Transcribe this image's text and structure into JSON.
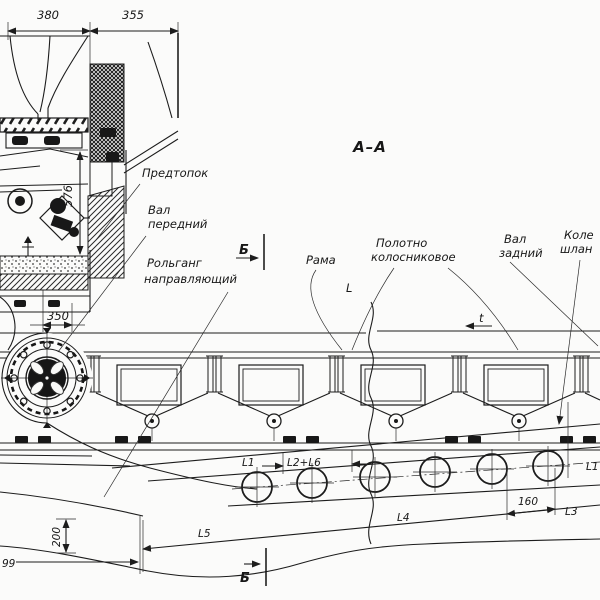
{
  "drawing": {
    "view_title": "А–А",
    "section_letter_top": "Б",
    "section_letter_bottom": "Б",
    "ink_color": "#1c1c1c",
    "paper_color": "#fbfbfa"
  },
  "labels": {
    "pre_furnace": "Предтопок",
    "front_shaft_l1": "Вал",
    "front_shaft_l2": "передний",
    "guide_rollgang_l1": "Рольганг",
    "guide_rollgang_l2": "направляющий",
    "frame": "Рама",
    "grate_belt_l1": "Полотно",
    "grate_belt_l2": "колосниковое",
    "rear_shaft_l1": "Вал",
    "rear_shaft_l2": "задний",
    "wheel_clipped_l1": "Коле",
    "wheel_clipped_l2": "шлан"
  },
  "dimensions": {
    "width_380": "380",
    "width_355": "355",
    "height_576": "576",
    "offset_350": "350",
    "span_L": "L",
    "pitch_t": "t",
    "len_L1": "L1",
    "len_L2_L6": "L2+L6",
    "len_L5": "L5",
    "len_L4": "L4",
    "roller_160": "160",
    "len_L3": "L3",
    "len_L1_right": "L1",
    "height_200": "200",
    "offset_99": "99"
  }
}
